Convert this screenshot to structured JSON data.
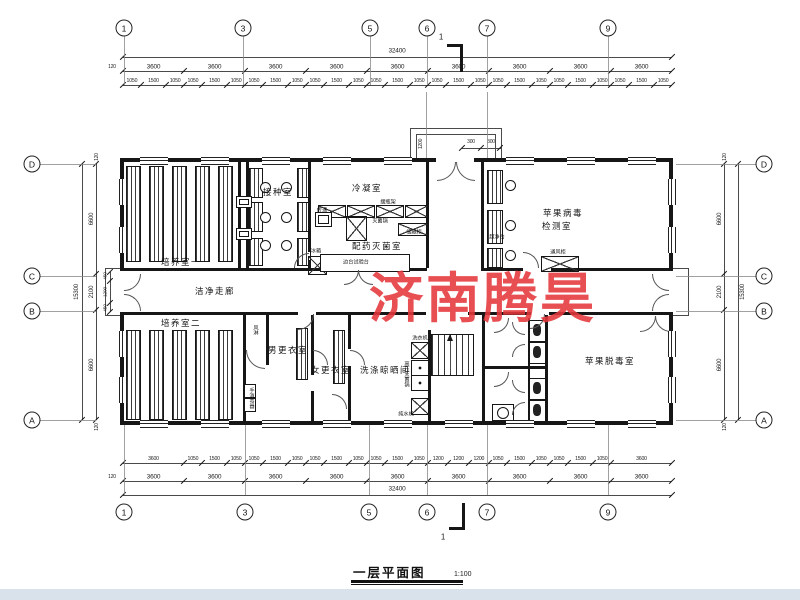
{
  "watermark": {
    "text": "济南腾昊",
    "color": "#e4373c"
  },
  "title": {
    "text": "一层平面图",
    "scale": "1:100"
  },
  "section_mark": {
    "label": "1"
  },
  "grid": {
    "top": [
      {
        "label": "1",
        "x": 124
      },
      {
        "label": "3",
        "x": 243
      },
      {
        "label": "5",
        "x": 370
      },
      {
        "label": "6",
        "x": 427
      },
      {
        "label": "7",
        "x": 487
      },
      {
        "label": "9",
        "x": 608
      }
    ],
    "bottom": [
      {
        "label": "1",
        "x": 124
      },
      {
        "label": "3",
        "x": 245
      },
      {
        "label": "5",
        "x": 369
      },
      {
        "label": "6",
        "x": 427
      },
      {
        "label": "7",
        "x": 487
      },
      {
        "label": "9",
        "x": 608
      }
    ],
    "left": [
      {
        "label": "D",
        "y": 164
      },
      {
        "label": "C",
        "y": 276
      },
      {
        "label": "B",
        "y": 311
      },
      {
        "label": "A",
        "y": 420
      }
    ],
    "right": [
      {
        "label": "D",
        "y": 164
      },
      {
        "label": "C",
        "y": 276
      },
      {
        "label": "B",
        "y": 311
      },
      {
        "label": "A",
        "y": 420
      }
    ]
  },
  "dims": {
    "top": {
      "overall": "32400",
      "cap": "120",
      "bays": [
        "3600",
        "3600",
        "3600",
        "3600",
        "3600",
        "3600",
        "3600",
        "3600",
        "3600"
      ],
      "fine": [
        "1050",
        "1500",
        "1050",
        "1050",
        "1500",
        "1050",
        "1050",
        "1500",
        "1050",
        "1050",
        "1500",
        "1050",
        "1050",
        "1500",
        "1050",
        "1050",
        "1500",
        "1050",
        "1050",
        "1500",
        "1050",
        "1050",
        "1500",
        "1050",
        "1050",
        "1500",
        "1050"
      ],
      "fine_mm": [
        1050,
        1500,
        1050,
        1050,
        1500,
        1050,
        1050,
        1500,
        1050,
        1050,
        1500,
        1050,
        1050,
        1500,
        1050,
        1050,
        1500,
        1050,
        1050,
        1500,
        1050,
        1050,
        1500,
        1050,
        1050,
        1500,
        1050
      ]
    },
    "bottom": {
      "overall": "32400",
      "cap": "120",
      "bays": [
        "3600",
        "3600",
        "3600",
        "3600",
        "3600",
        "3600",
        "3600",
        "3600",
        "3600"
      ],
      "fine": [
        "3600",
        "1050",
        "1500",
        "1050",
        "1050",
        "1500",
        "1050",
        "1050",
        "1500",
        "1050",
        "1050",
        "1500",
        "1050",
        "1200",
        "1200",
        "1200",
        "1050",
        "1500",
        "1050",
        "1050",
        "1500",
        "1050",
        "3600"
      ],
      "fine_mm": [
        3600,
        1050,
        1500,
        1050,
        1050,
        1500,
        1050,
        1050,
        1500,
        1050,
        1050,
        1500,
        1050,
        1200,
        1200,
        1200,
        1050,
        1500,
        1050,
        1050,
        1500,
        1050,
        3600
      ]
    },
    "left": {
      "overall": "15300",
      "segments": [
        "6600",
        "2100",
        "6600"
      ],
      "seg_mm": [
        6600,
        2100,
        6600
      ],
      "caps": [
        "120",
        "120"
      ],
      "fine": [
        "450",
        "1200",
        "450"
      ],
      "fine_mm": [
        450,
        1200,
        450
      ]
    },
    "right": {
      "overall": "15300",
      "segments": [
        "6600",
        "2100",
        "6600"
      ],
      "seg_mm": [
        6600,
        2100,
        6600
      ],
      "caps": [
        "120",
        "120"
      ]
    },
    "porch": [
      "1200",
      "300",
      "300"
    ]
  },
  "rooms": [
    {
      "label": "培养室一",
      "x": 181,
      "y": 262
    },
    {
      "label": "接种室",
      "x": 278,
      "y": 192
    },
    {
      "label": "冷凝室",
      "x": 367,
      "y": 188
    },
    {
      "label": "配药灭菌室",
      "x": 377,
      "y": 246
    },
    {
      "label": "苹果病毒",
      "x": 563,
      "y": 213
    },
    {
      "label": "检测室",
      "x": 557,
      "y": 226
    },
    {
      "label": "洁净走廊",
      "x": 215,
      "y": 291
    },
    {
      "label": "培养室二",
      "x": 181,
      "y": 323
    },
    {
      "label": "男更衣室",
      "x": 288,
      "y": 350
    },
    {
      "label": "女更衣室",
      "x": 331,
      "y": 370
    },
    {
      "label": "洗涤晾晒间",
      "x": 385,
      "y": 370
    },
    {
      "label": "苹果脱毒室",
      "x": 610,
      "y": 361
    }
  ],
  "labels": [
    {
      "text": "灭菌锅",
      "x": 380,
      "y": 221
    },
    {
      "text": "储藏柜",
      "x": 414,
      "y": 232
    },
    {
      "text": "摆瓶架",
      "x": 388,
      "y": 202
    },
    {
      "text": "边台试验台",
      "x": 356,
      "y": 262
    },
    {
      "text": "冰箱",
      "x": 316,
      "y": 251
    },
    {
      "text": "传递",
      "x": 322,
      "y": 210
    },
    {
      "text": "超净台",
      "x": 497,
      "y": 237
    },
    {
      "text": "通风柜",
      "x": 558,
      "y": 252
    },
    {
      "text": "洗衣机",
      "x": 420,
      "y": 338
    },
    {
      "text": "高压灭菌锅",
      "x": 407,
      "y": 374,
      "vertical": true
    },
    {
      "text": "纯水机",
      "x": 406,
      "y": 414
    },
    {
      "text": "风淋",
      "x": 256,
      "y": 330,
      "vertical": true
    },
    {
      "text": "手消毒器",
      "x": 252,
      "y": 398,
      "vertical": true
    }
  ]
}
